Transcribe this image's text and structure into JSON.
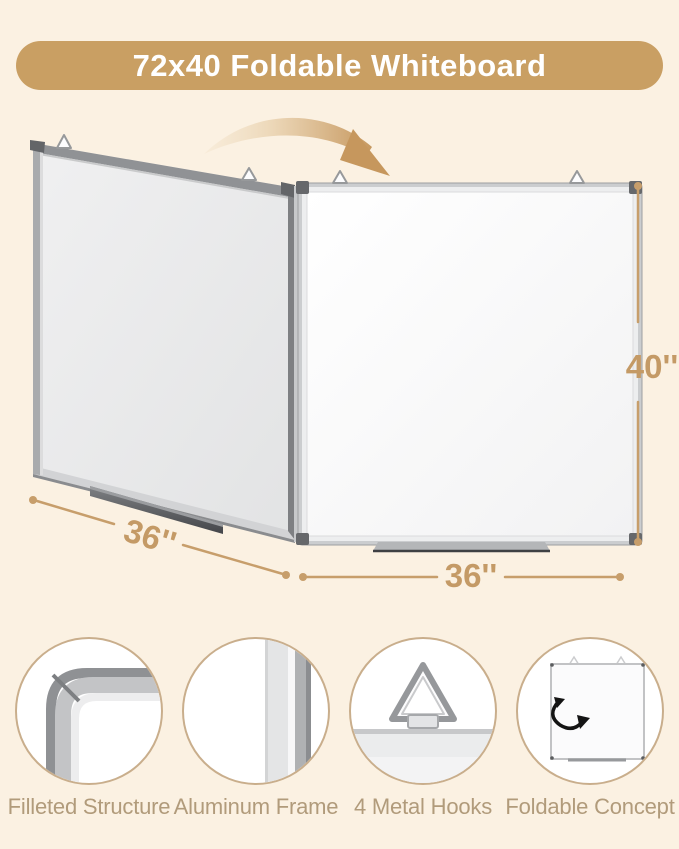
{
  "page": {
    "background_color": "#FBF1E2"
  },
  "banner": {
    "title": "72x40 Foldable Whiteboard",
    "background_color": "#C99F63",
    "text_color": "#FFFFFF"
  },
  "illustration": {
    "fold_arrow_icon": "fold-direction-arrow",
    "left_panel": "left-whiteboard-panel",
    "right_panel": "right-whiteboard-panel",
    "hook_icon": "hanging-hook-icon",
    "hooks_visible": 4,
    "tray_icon": "marker-tray"
  },
  "dimensions": {
    "height_label": "40''",
    "left_width_label": "36''",
    "bottom_width_label": "36''",
    "accent_color": "#C79E6B"
  },
  "features": [
    {
      "label": "Filleted Structure",
      "icon": "rounded-corner-icon"
    },
    {
      "label": "Aluminum Frame",
      "icon": "frame-profile-icon"
    },
    {
      "label": "4 Metal Hooks",
      "icon": "triangle-hook-icon"
    },
    {
      "label": "Foldable Concept",
      "icon": "folding-board-icon"
    }
  ]
}
